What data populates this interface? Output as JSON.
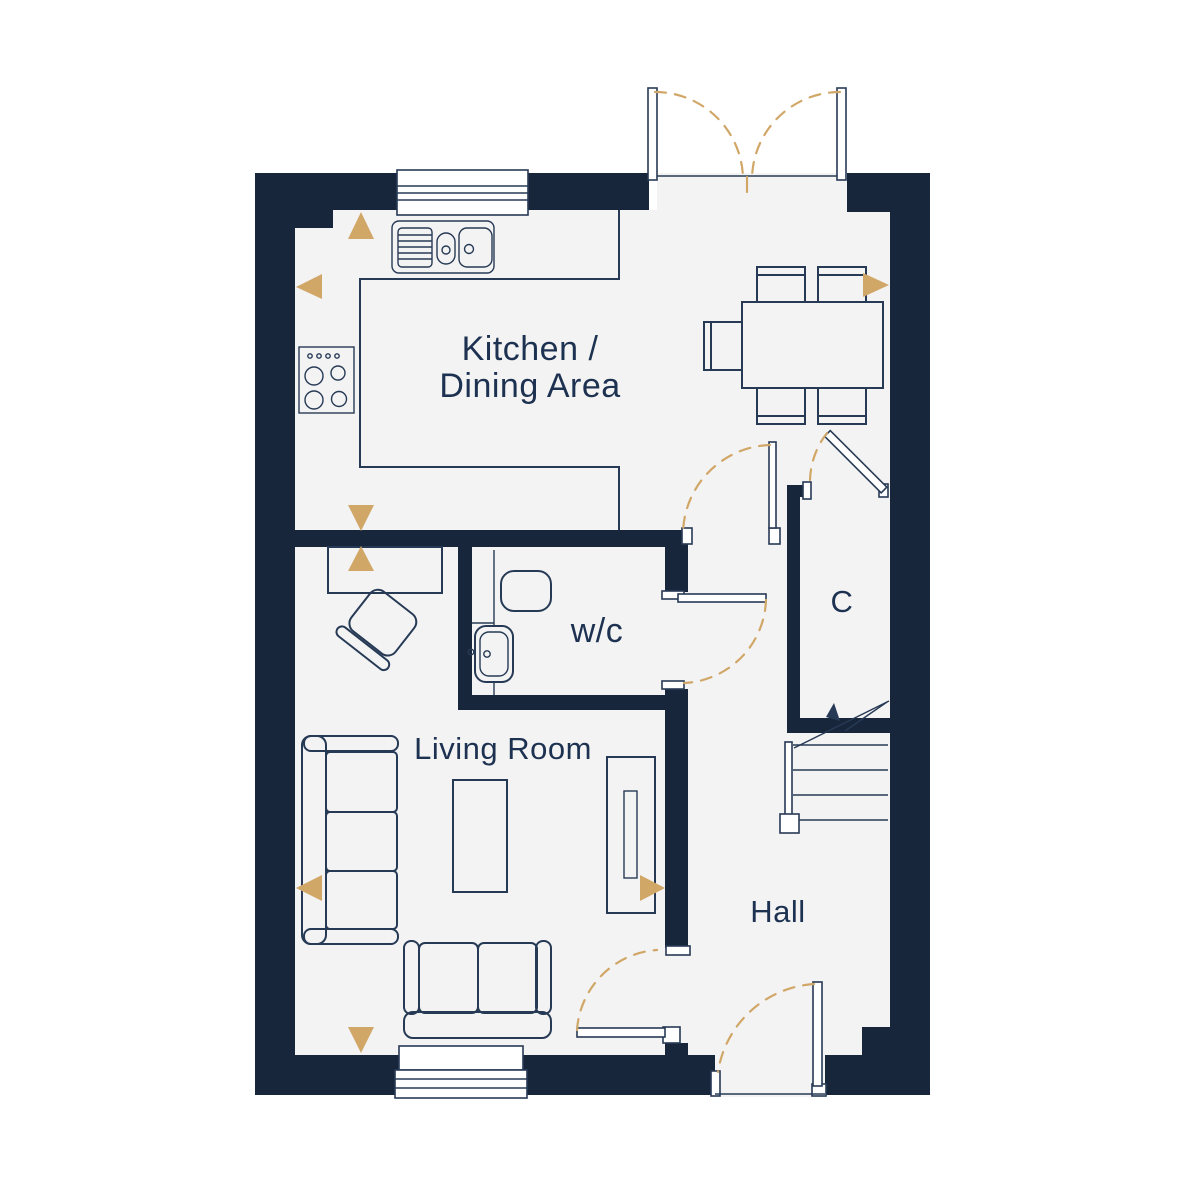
{
  "plan": {
    "rooms": {
      "kitchen_dining": {
        "label_line1": "Kitchen /",
        "label_line2": "Dining Area"
      },
      "wc": {
        "label": "w/c"
      },
      "living_room": {
        "label": "Living Room"
      },
      "hall": {
        "label": "Hall"
      },
      "cupboard": {
        "label": "C"
      }
    },
    "colors": {
      "wall": "#17263b",
      "floor": "#f3f3f4",
      "line": "#273a55",
      "gold": "#d1a768",
      "text": "#1d3150",
      "background": "#ffffff"
    }
  }
}
